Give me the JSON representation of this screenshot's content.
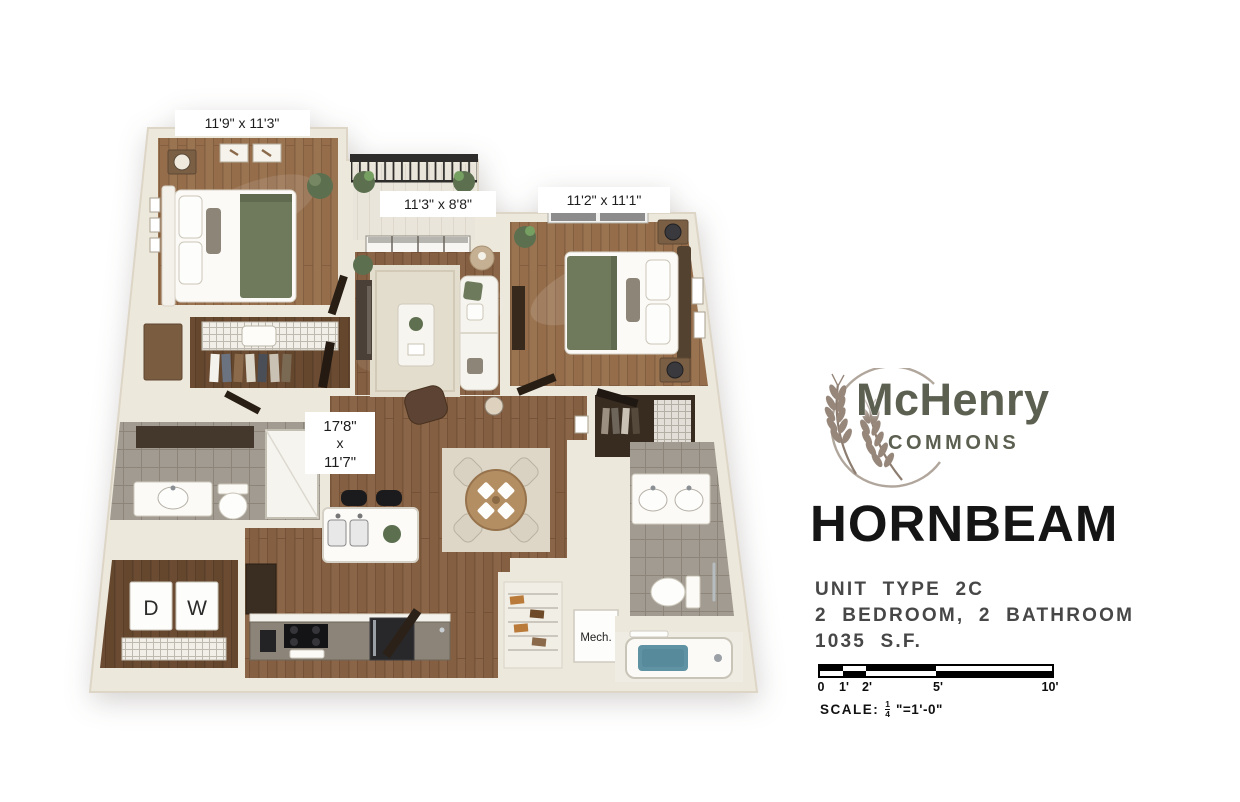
{
  "branding": {
    "name": "McHenry",
    "subname": "COMMONS"
  },
  "unit": {
    "name": "HORNBEAM",
    "type": "UNIT TYPE 2C",
    "layout": "2 BEDROOM, 2 BATHROOM",
    "area": "1035 S.F."
  },
  "scale_bar": {
    "ticks": [
      "0",
      "1'",
      "2'",
      "5'",
      "10'"
    ],
    "label": "SCALE:",
    "numerator": "1",
    "denominator": "4",
    "suffix": "\"=1'-0\""
  },
  "floor_plan": {
    "bedroom_1": {
      "dimensions": "11'9\" x 11'3\""
    },
    "balcony": {
      "dimensions": "11'3\" x 8'8\""
    },
    "bedroom_2": {
      "dimensions": "11'2\" x 11'1\""
    },
    "living_room": {
      "width": "17'8\"",
      "separator": "x",
      "length": "11'7\""
    },
    "laundry": {
      "dryer": "D",
      "washer": "W"
    },
    "mechanical": {
      "label": "Mech."
    }
  },
  "colors": {
    "wall": "#ede8dc",
    "wood_floor": "#8a6547",
    "tile_floor": "#a29b91",
    "logo_green": "#5c6051",
    "wheat": "#97877b",
    "title_black": "#151515",
    "info_gray": "#474747",
    "tub_water": "#5f93a3",
    "plant_green": "#5c7050"
  }
}
